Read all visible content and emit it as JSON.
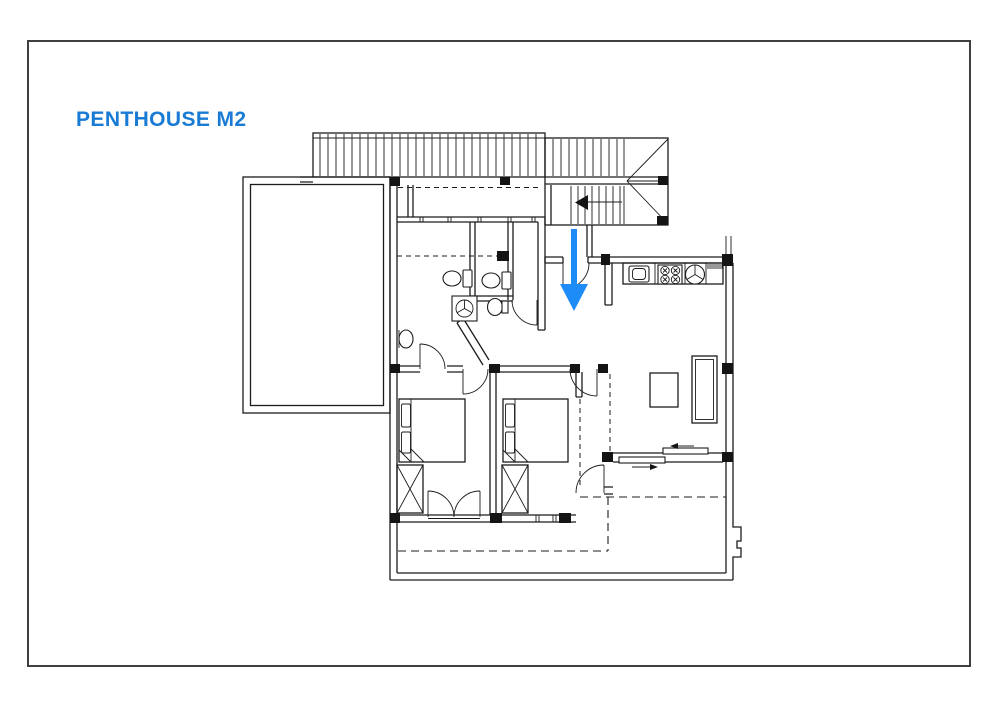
{
  "page": {
    "title": "PENTHOUSE M2"
  },
  "colors": {
    "title": "#1a7bd4",
    "arrow": "#1e8cf7",
    "line": "#1c1c1c",
    "frame": "#3f3f3f",
    "background": "#ffffff",
    "column_fill": "#141414"
  }
}
